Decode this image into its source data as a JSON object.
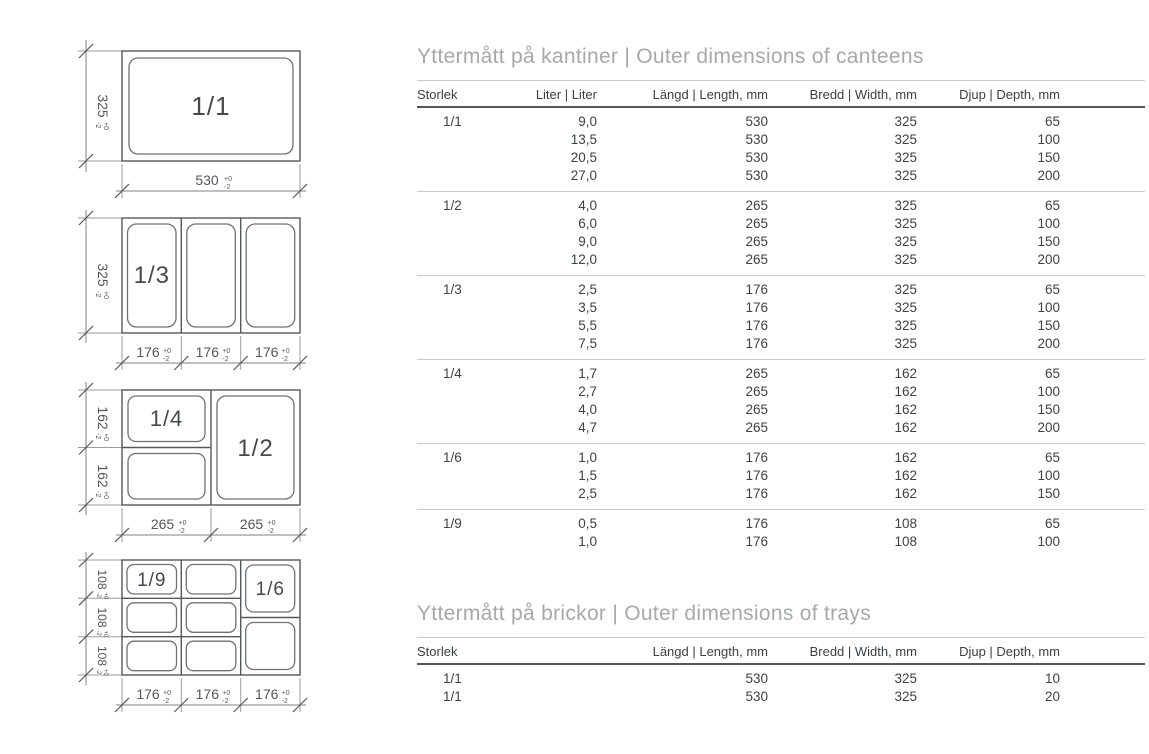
{
  "colors": {
    "title_gray": "#a6a9ab",
    "text_dark": "#3e4245",
    "line_gray": "#55585a"
  },
  "tolerance": {
    "plus": "+0",
    "minus": "-2"
  },
  "diagrams": [
    {
      "pan_labels": [
        "1/1"
      ],
      "side_dims": [
        "325"
      ],
      "bottom_dims": [
        "530"
      ]
    },
    {
      "pan_labels": [
        "1/3"
      ],
      "side_dims": [
        "325"
      ],
      "bottom_dims": [
        "176",
        "176",
        "176"
      ]
    },
    {
      "pan_labels": [
        "1/4",
        "1/2"
      ],
      "side_dims": [
        "162",
        "162"
      ],
      "bottom_dims": [
        "265",
        "265"
      ]
    },
    {
      "pan_labels": [
        "1/9",
        "1/6"
      ],
      "side_dims": [
        "108",
        "108",
        "108"
      ],
      "bottom_dims": [
        "176",
        "176",
        "176"
      ]
    }
  ],
  "canteens_table": {
    "title": "Yttermått på kantiner | Outer dimensions of canteens",
    "headers": [
      "Storlek",
      "Liter | Liter",
      "Längd | Length, mm",
      "Bredd | Width, mm",
      "Djup | Depth, mm"
    ],
    "groups": [
      {
        "storlek": "1/1",
        "rows": [
          [
            "9,0",
            "530",
            "325",
            "65"
          ],
          [
            "13,5",
            "530",
            "325",
            "100"
          ],
          [
            "20,5",
            "530",
            "325",
            "150"
          ],
          [
            "27,0",
            "530",
            "325",
            "200"
          ]
        ]
      },
      {
        "storlek": "1/2",
        "rows": [
          [
            "4,0",
            "265",
            "325",
            "65"
          ],
          [
            "6,0",
            "265",
            "325",
            "100"
          ],
          [
            "9,0",
            "265",
            "325",
            "150"
          ],
          [
            "12,0",
            "265",
            "325",
            "200"
          ]
        ]
      },
      {
        "storlek": "1/3",
        "rows": [
          [
            "2,5",
            "176",
            "325",
            "65"
          ],
          [
            "3,5",
            "176",
            "325",
            "100"
          ],
          [
            "5,5",
            "176",
            "325",
            "150"
          ],
          [
            "7,5",
            "176",
            "325",
            "200"
          ]
        ]
      },
      {
        "storlek": "1/4",
        "rows": [
          [
            "1,7",
            "265",
            "162",
            "65"
          ],
          [
            "2,7",
            "265",
            "162",
            "100"
          ],
          [
            "4,0",
            "265",
            "162",
            "150"
          ],
          [
            "4,7",
            "265",
            "162",
            "200"
          ]
        ]
      },
      {
        "storlek": "1/6",
        "rows": [
          [
            "1,0",
            "176",
            "162",
            "65"
          ],
          [
            "1,5",
            "176",
            "162",
            "100"
          ],
          [
            "2,5",
            "176",
            "162",
            "150"
          ]
        ]
      },
      {
        "storlek": "1/9",
        "rows": [
          [
            "0,5",
            "176",
            "108",
            "65"
          ],
          [
            "1,0",
            "176",
            "108",
            "100"
          ]
        ]
      }
    ]
  },
  "trays_table": {
    "title": "Yttermått på brickor | Outer dimensions of trays",
    "headers": [
      "Storlek",
      "Längd | Length, mm",
      "Bredd | Width, mm",
      "Djup | Depth, mm"
    ],
    "rows": [
      {
        "storlek": "1/1",
        "values": [
          "530",
          "325",
          "10"
        ]
      },
      {
        "storlek": "1/1",
        "values": [
          "530",
          "325",
          "20"
        ]
      }
    ]
  }
}
